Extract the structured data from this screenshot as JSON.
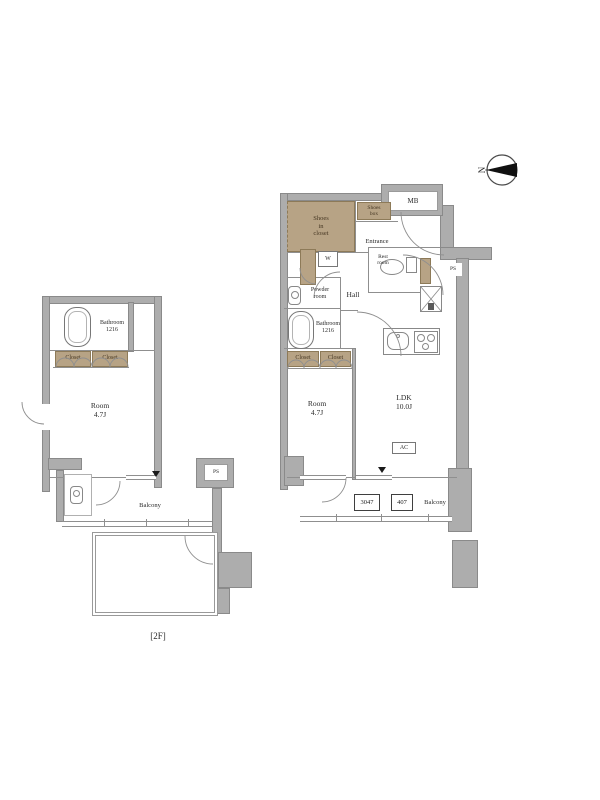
{
  "floor_note": "[2F]",
  "compass": {
    "label": "N"
  },
  "colors": {
    "wall": "#adadad",
    "closet_tan": "#b7a385",
    "line": "#8f8f8f",
    "label_dark": "#463723"
  },
  "icons": {
    "compass": "north-pointer-circle",
    "bathtub": "rounded-rect-tub",
    "toilet": "bowl-and-tank",
    "washbasin": "basin-with-circle",
    "kitchen_sink": "rounded-rect-sink",
    "stove": "burner-circles",
    "refrigerator": "crossed-box",
    "door": "quarter-arc-swing"
  },
  "right_unit": {
    "mb_label": "MB",
    "shoes_closet": {
      "line1": "Shoes",
      "line2": "in",
      "line3": "closet"
    },
    "shoes_box": {
      "line1": "Shoes",
      "line2": "box"
    },
    "entrance_label": "Entrance",
    "washer_label": "W",
    "rest_room": {
      "line1": "Rest",
      "line2": "room"
    },
    "ps_label": "PS",
    "powder_room": {
      "line1": "Powder",
      "line2": "room"
    },
    "hall_label": "Hall",
    "bathroom": {
      "line1": "Bathroom",
      "line2": "1216"
    },
    "closet1_label": "Closet",
    "closet2_label": "Closet",
    "room": {
      "line1": "Room",
      "line2": "4.7J"
    },
    "ldk": {
      "line1": "LDK",
      "line2": "10.0J"
    },
    "ac_label": "AC",
    "balcony_label": "Balcony",
    "hatch1_label": "3047",
    "hatch2_label": "407"
  },
  "left_unit": {
    "bathroom": {
      "line1": "Bathroom",
      "line2": "1216"
    },
    "closet1_label": "Closet",
    "closet2_label": "Closet",
    "room": {
      "line1": "Room",
      "line2": "4.7J"
    },
    "balcony_label": "Balcony",
    "ps_label": "PS"
  }
}
